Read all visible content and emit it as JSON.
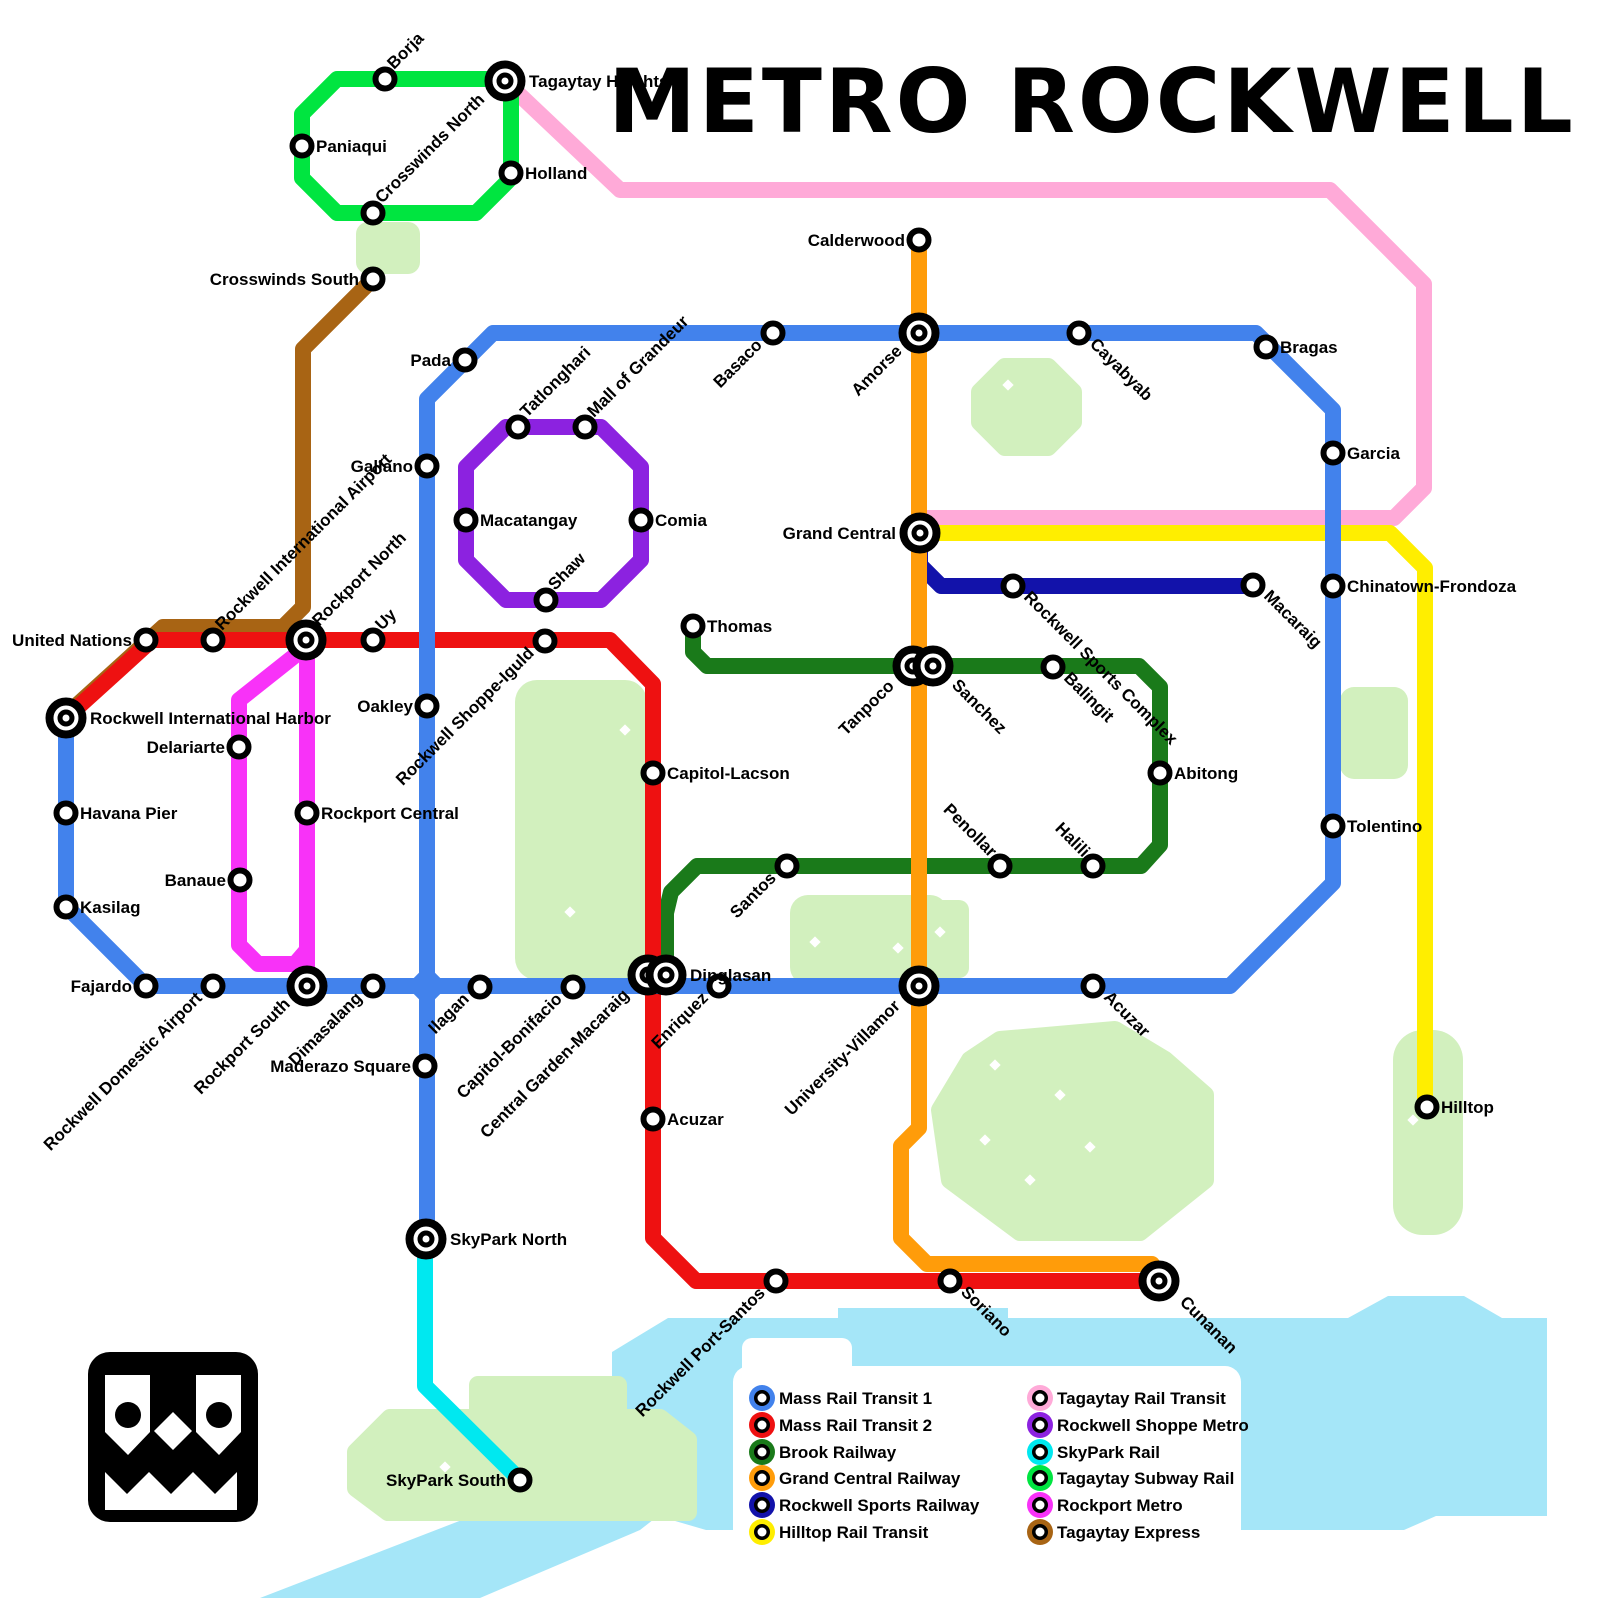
{
  "title": "METRO ROCKWELL",
  "colors": {
    "background": "#ffffff",
    "park": "#d2f0be",
    "water": "#a5e6f8",
    "label": "#000000"
  },
  "legend": {
    "columns": [
      [
        {
          "label": "Mass Rail Transit 1",
          "color": "#4282ec"
        },
        {
          "label": "Mass Rail Transit 2",
          "color": "#ee1111"
        },
        {
          "label": "Brook Railway",
          "color": "#1a7a1a"
        },
        {
          "label": "Grand Central Railway",
          "color": "#ff9c0a"
        },
        {
          "label": "Rockwell Sports Railway",
          "color": "#1212aa"
        },
        {
          "label": "Hilltop Rail Transit",
          "color": "#ffee00"
        }
      ],
      [
        {
          "label": "Tagaytay Rail Transit",
          "color": "#ffaad8"
        },
        {
          "label": "Rockwell Shoppe Metro",
          "color": "#8c22e0"
        },
        {
          "label": "SkyPark Rail",
          "color": "#00e8f0"
        },
        {
          "label": "Tagaytay Subway Rail",
          "color": "#00e540"
        },
        {
          "label": "Rockport Metro",
          "color": "#f832f8"
        },
        {
          "label": "Tagaytay Express",
          "color": "#a86414"
        }
      ]
    ]
  },
  "lines": [
    {
      "id": "tagaytay-rail-transit",
      "name": "Tagaytay Rail Transit",
      "color": "#ffaad8",
      "paths": [
        [
          [
            505,
            81
          ],
          [
            620,
            190
          ],
          [
            1330,
            190
          ],
          [
            1424,
            284
          ],
          [
            1424,
            488
          ],
          [
            1394,
            518
          ],
          [
            920,
            518
          ]
        ]
      ]
    },
    {
      "id": "hilltop-rail-transit",
      "name": "Hilltop Rail Transit",
      "color": "#ffee00",
      "paths": [
        [
          [
            920,
            533
          ],
          [
            1390,
            533
          ],
          [
            1425,
            568
          ],
          [
            1425,
            1107
          ]
        ]
      ]
    },
    {
      "id": "rockwell-sports-railway",
      "name": "Rockwell Sports Railway",
      "color": "#1212aa",
      "paths": [
        [
          [
            920,
            540
          ],
          [
            920,
            565
          ],
          [
            941,
            586
          ],
          [
            1253,
            586
          ]
        ]
      ]
    },
    {
      "id": "tagaytay-express",
      "name": "Tagaytay Express",
      "color": "#a86414",
      "paths": [
        [
          [
            373,
            279
          ],
          [
            303,
            349
          ],
          [
            303,
            607
          ],
          [
            283,
            627
          ],
          [
            163,
            627
          ],
          [
            66,
            715
          ]
        ]
      ]
    },
    {
      "id": "rockport-metro",
      "name": "Rockport Metro",
      "color": "#f832f8",
      "paths": [
        [
          [
            307,
            650
          ],
          [
            307,
            978
          ]
        ],
        [
          [
            302,
            650
          ],
          [
            239,
            700
          ],
          [
            239,
            945
          ],
          [
            258,
            964
          ],
          [
            295,
            964
          ],
          [
            307,
            950
          ]
        ]
      ]
    },
    {
      "id": "skypark-rail",
      "name": "SkyPark Rail",
      "color": "#00e8f0",
      "paths": [
        [
          [
            425,
            1250
          ],
          [
            425,
            1386
          ],
          [
            518,
            1478
          ]
        ]
      ]
    },
    {
      "id": "tagaytay-subway-rail",
      "name": "Tagaytay Subway Rail",
      "color": "#00e540",
      "paths": [
        [
          [
            337,
            79
          ],
          [
            497,
            79
          ],
          [
            511,
            93
          ],
          [
            511,
            178
          ],
          [
            476,
            213
          ],
          [
            337,
            213
          ],
          [
            302,
            178
          ],
          [
            302,
            114
          ],
          [
            337,
            79
          ]
        ]
      ]
    },
    {
      "id": "rockwell-shoppe-metro",
      "name": "Rockwell Shoppe Metro",
      "color": "#8c22e0",
      "paths": [
        [
          [
            506,
            427
          ],
          [
            601,
            427
          ],
          [
            641,
            467
          ],
          [
            641,
            560
          ],
          [
            601,
            600
          ],
          [
            506,
            600
          ],
          [
            466,
            560
          ],
          [
            466,
            467
          ],
          [
            506,
            427
          ]
        ]
      ]
    },
    {
      "id": "brook-railway",
      "name": "Brook Railway",
      "color": "#1a7a1a",
      "paths": [
        [
          [
            693,
            626
          ],
          [
            693,
            652
          ],
          [
            707,
            666
          ],
          [
            1139,
            666
          ],
          [
            1160,
            687
          ],
          [
            1160,
            845
          ],
          [
            1141,
            866
          ],
          [
            697,
            866
          ],
          [
            671,
            892
          ],
          [
            666,
            913
          ],
          [
            666,
            970
          ]
        ]
      ]
    },
    {
      "id": "mass-rail-transit-2",
      "name": "Mass Rail Transit 2",
      "color": "#ee1111",
      "paths": [
        [
          [
            66,
            718
          ],
          [
            152,
            640
          ],
          [
            610,
            640
          ],
          [
            653,
            684
          ],
          [
            653,
            1238
          ],
          [
            696,
            1281
          ],
          [
            1159,
            1281
          ]
        ]
      ]
    },
    {
      "id": "grand-central-railway",
      "name": "Grand Central Railway",
      "color": "#ff9c0a",
      "paths": [
        [
          [
            919,
            240
          ],
          [
            919,
            1128
          ],
          [
            901,
            1146
          ],
          [
            901,
            1238
          ],
          [
            927,
            1264
          ],
          [
            1152,
            1264
          ]
        ]
      ]
    },
    {
      "id": "mass-rail-transit-1",
      "name": "Mass Rail Transit 1",
      "color": "#4282ec",
      "paths": [
        [
          [
            66,
            718
          ],
          [
            66,
            906
          ],
          [
            146,
            986
          ],
          [
            1230,
            986
          ],
          [
            1333,
            883
          ],
          [
            1333,
            410
          ],
          [
            1256,
            333
          ],
          [
            493,
            333
          ],
          [
            427,
            399
          ],
          [
            427,
            1239
          ]
        ]
      ]
    }
  ],
  "stations": [
    {
      "n": "Borja",
      "x": 385,
      "y": 79,
      "t": "s",
      "r": -45,
      "a": "s"
    },
    {
      "n": "Tagaytay Heights",
      "x": 505,
      "y": 81,
      "t": "i",
      "r": 0,
      "a": "s",
      "dx": 10
    },
    {
      "n": "Paniaqui",
      "x": 302,
      "y": 146,
      "t": "s",
      "r": 0,
      "a": "s"
    },
    {
      "n": "Holland",
      "x": 511,
      "y": 173,
      "t": "s",
      "r": 0,
      "a": "s"
    },
    {
      "n": "Crosswinds North",
      "x": 373,
      "y": 213,
      "t": "s",
      "r": -45,
      "a": "s"
    },
    {
      "n": "Crosswinds South",
      "x": 373,
      "y": 279,
      "t": "s",
      "r": 0,
      "a": "e"
    },
    {
      "n": "United Nations",
      "x": 146,
      "y": 640,
      "t": "s",
      "r": 0,
      "a": "e"
    },
    {
      "n": "Rockwell International Airport",
      "x": 213,
      "y": 640,
      "t": "s",
      "r": -45,
      "a": "s"
    },
    {
      "n": "Rockport North",
      "x": 306,
      "y": 640,
      "t": "i",
      "r": -45,
      "a": "s",
      "dx": 4,
      "dy": -4
    },
    {
      "n": "Uy",
      "x": 373,
      "y": 640,
      "t": "s",
      "r": -45,
      "a": "s"
    },
    {
      "n": "Rockwell Shoppe-Iguld",
      "x": 545,
      "y": 641,
      "t": "s",
      "r": -45,
      "a": "e"
    },
    {
      "n": "Rockwell International Harbor",
      "x": 66,
      "y": 718,
      "t": "i",
      "r": 0,
      "a": "s",
      "dx": 10
    },
    {
      "n": "Havana Pier",
      "x": 66,
      "y": 813,
      "t": "s",
      "r": 0,
      "a": "s"
    },
    {
      "n": "Kasilag",
      "x": 66,
      "y": 907,
      "t": "s",
      "r": 0,
      "a": "s"
    },
    {
      "n": "Fajardo",
      "x": 146,
      "y": 986,
      "t": "s",
      "r": 0,
      "a": "e"
    },
    {
      "n": "Rockwell Domestic Airport",
      "x": 213,
      "y": 986,
      "t": "s",
      "r": -45,
      "a": "e"
    },
    {
      "n": "Rockport South",
      "x": 307,
      "y": 986,
      "t": "i",
      "r": -45,
      "a": "e",
      "dx": -6,
      "dy": 6
    },
    {
      "n": "Dimasalang",
      "x": 373,
      "y": 986,
      "t": "s",
      "r": -45,
      "a": "e"
    },
    {
      "n": "Ilagan",
      "x": 480,
      "y": 987,
      "t": "s",
      "r": -45,
      "a": "e"
    },
    {
      "n": "Capitol-Bonifacio",
      "x": 573,
      "y": 987,
      "t": "s",
      "r": -45,
      "a": "e"
    },
    {
      "n": "Central Garden-Macaraig",
      "x": 648,
      "y": 975,
      "t": "i",
      "r": -45,
      "a": "e",
      "dx": -8,
      "dy": 8
    },
    {
      "n": "Dinglasan",
      "x": 666,
      "y": 975,
      "t": "i",
      "r": 0,
      "a": "s",
      "dx": 10
    },
    {
      "n": "Enriquez",
      "x": 719,
      "y": 986,
      "t": "s",
      "r": -45,
      "a": "e"
    },
    {
      "n": "Maderazo Square",
      "x": 425,
      "y": 1066,
      "t": "s",
      "r": 0,
      "a": "e"
    },
    {
      "n": "Banaue",
      "x": 240,
      "y": 880,
      "t": "s",
      "r": 0,
      "a": "e"
    },
    {
      "n": "Delariarte",
      "x": 239,
      "y": 747,
      "t": "s",
      "r": 0,
      "a": "e"
    },
    {
      "n": "Rockport Central",
      "x": 307,
      "y": 813,
      "t": "s",
      "r": 0,
      "a": "s"
    },
    {
      "n": "Oakley",
      "x": 427,
      "y": 706,
      "t": "s",
      "r": 0,
      "a": "e"
    },
    {
      "n": "Galiano",
      "x": 427,
      "y": 466,
      "t": "s",
      "r": 0,
      "a": "e"
    },
    {
      "n": "Pada",
      "x": 465,
      "y": 360,
      "t": "s",
      "r": 0,
      "a": "e"
    },
    {
      "n": "Tatlonghari",
      "x": 518,
      "y": 427,
      "t": "s",
      "r": -45,
      "a": "s"
    },
    {
      "n": "Mall of Grandeur",
      "x": 585,
      "y": 427,
      "t": "s",
      "r": -45,
      "a": "s"
    },
    {
      "n": "Macatangay",
      "x": 466,
      "y": 520,
      "t": "s",
      "r": 0,
      "a": "s"
    },
    {
      "n": "Comia",
      "x": 641,
      "y": 520,
      "t": "s",
      "r": 0,
      "a": "s"
    },
    {
      "n": "Shaw",
      "x": 546,
      "y": 600,
      "t": "s",
      "r": -45,
      "a": "s"
    },
    {
      "n": "Basaco",
      "x": 773,
      "y": 333,
      "t": "s",
      "r": -45,
      "a": "e"
    },
    {
      "n": "Amorse",
      "x": 919,
      "y": 333,
      "t": "i",
      "r": -45,
      "a": "e",
      "dx": -6,
      "dy": 6
    },
    {
      "n": "Cayabyab",
      "x": 1079,
      "y": 333,
      "t": "s",
      "r": 45,
      "a": "s"
    },
    {
      "n": "Bragas",
      "x": 1266,
      "y": 347,
      "t": "s",
      "r": 0,
      "a": "s"
    },
    {
      "n": "Garcia",
      "x": 1333,
      "y": 453,
      "t": "s",
      "r": 0,
      "a": "s"
    },
    {
      "n": "Chinatown-Frondoza",
      "x": 1333,
      "y": 586,
      "t": "s",
      "r": 0,
      "a": "s"
    },
    {
      "n": "Tolentino",
      "x": 1333,
      "y": 826,
      "t": "s",
      "r": 0,
      "a": "s"
    },
    {
      "n": "Calderwood",
      "x": 919,
      "y": 240,
      "t": "s",
      "r": 0,
      "a": "e"
    },
    {
      "n": "Grand Central",
      "x": 920,
      "y": 533,
      "t": "i",
      "r": 0,
      "a": "e",
      "dx": -10
    },
    {
      "n": "Thomas",
      "x": 693,
      "y": 626,
      "t": "s",
      "r": 0,
      "a": "s"
    },
    {
      "n": "Tanpoco",
      "x": 913,
      "y": 666,
      "t": "i",
      "r": -45,
      "a": "e",
      "dx": -8,
      "dy": 8
    },
    {
      "n": "Sanchez",
      "x": 933,
      "y": 666,
      "t": "i",
      "r": 45,
      "a": "s",
      "dx": 8,
      "dy": 8
    },
    {
      "n": "Rockwell Sports Complex",
      "x": 1013,
      "y": 586,
      "t": "s",
      "r": 45,
      "a": "s"
    },
    {
      "n": "Balingit",
      "x": 1053,
      "y": 667,
      "t": "s",
      "r": 45,
      "a": "s"
    },
    {
      "n": "Macaraig",
      "x": 1253,
      "y": 585,
      "t": "s",
      "r": 45,
      "a": "s"
    },
    {
      "n": "Abitong",
      "x": 1160,
      "y": 773,
      "t": "s",
      "r": 0,
      "a": "s"
    },
    {
      "n": "Halili",
      "x": 1093,
      "y": 866,
      "t": "s",
      "r": 45,
      "a": "e"
    },
    {
      "n": "Penollar",
      "x": 1000,
      "y": 866,
      "t": "s",
      "r": 45,
      "a": "e"
    },
    {
      "n": "Santos",
      "x": 787,
      "y": 866,
      "t": "s",
      "r": -45,
      "a": "e"
    },
    {
      "n": "Capitol-Lacson",
      "x": 653,
      "y": 773,
      "t": "s",
      "r": 0,
      "a": "s"
    },
    {
      "n": "Acuzar",
      "x": 653,
      "y": 1119,
      "t": "s",
      "r": 0,
      "a": "s"
    },
    {
      "n": "University-Villamor",
      "x": 919,
      "y": 986,
      "t": "i",
      "r": -45,
      "a": "e",
      "dx": -8,
      "dy": 8
    },
    {
      "n": "Acuzar",
      "x": 1093,
      "y": 986,
      "t": "s",
      "r": 45,
      "a": "s"
    },
    {
      "n": "SkyPark North",
      "x": 426,
      "y": 1239,
      "t": "i",
      "r": 0,
      "a": "s",
      "dx": 10
    },
    {
      "n": "SkyPark South",
      "x": 520,
      "y": 1480,
      "t": "s",
      "r": 0,
      "a": "e"
    },
    {
      "n": "Rockwell Port-Santos",
      "x": 776,
      "y": 1281,
      "t": "s",
      "r": -45,
      "a": "e"
    },
    {
      "n": "Soriano",
      "x": 950,
      "y": 1281,
      "t": "s",
      "r": 45,
      "a": "s"
    },
    {
      "n": "Cunanan",
      "x": 1159,
      "y": 1281,
      "t": "i",
      "r": 45,
      "a": "s",
      "dx": 10,
      "dy": 10
    },
    {
      "n": "Hilltop",
      "x": 1427,
      "y": 1107,
      "t": "s",
      "r": 0,
      "a": "s"
    }
  ],
  "parks": [
    {
      "type": "rect",
      "x": 356,
      "y": 222,
      "w": 64,
      "h": 52,
      "rad": 12
    },
    {
      "type": "poly",
      "points": "1005,367 1048,367 1073,392 1073,422 1048,447 1005,447 980,422 980,392"
    },
    {
      "type": "rect",
      "x": 515,
      "y": 680,
      "w": 132,
      "h": 300,
      "rad": 22
    },
    {
      "type": "rect",
      "x": 1340,
      "y": 687,
      "w": 68,
      "h": 92,
      "rad": 14
    },
    {
      "type": "rect",
      "x": 927,
      "y": 900,
      "w": 42,
      "h": 78,
      "rad": 10
    },
    {
      "type": "rect",
      "x": 790,
      "y": 895,
      "w": 158,
      "h": 90,
      "rad": 18
    },
    {
      "type": "poly",
      "points": "1000,1040 1115,1030 1165,1060 1205,1095 1205,1180 1140,1232 1020,1232 950,1180 940,1110 970,1060"
    },
    {
      "type": "rect",
      "x": 1393,
      "y": 1030,
      "w": 70,
      "h": 205,
      "rad": 30
    },
    {
      "type": "poly",
      "points": "478,1385 618,1385 618,1418 660,1418 688,1440 688,1512 388,1512 356,1488 356,1452 390,1418 478,1418"
    }
  ],
  "water": {
    "points": "668,1318 838,1318 838,1308 1008,1308 1008,1318 1348,1318 1388,1296 1464,1296 1502,1318 1547,1318 1547,1516 1436,1516 1404,1530 706,1530 658,1516 640,1530 480,1598 260,1598 612,1462 612,1352"
  },
  "sparkles": [
    [
      625,
      730
    ],
    [
      570,
      912
    ],
    [
      815,
      942
    ],
    [
      898,
      948
    ],
    [
      940,
      932
    ],
    [
      995,
      1065
    ],
    [
      1060,
      1095
    ],
    [
      1090,
      1147
    ],
    [
      985,
      1140
    ],
    [
      1030,
      1180
    ],
    [
      1413,
      1120
    ],
    [
      445,
      1467
    ],
    [
      1008,
      385
    ]
  ],
  "junction": {
    "x": 427,
    "y": 986
  },
  "legend_layout": {
    "panel": {
      "x": 733,
      "y": 1366,
      "w": 508,
      "h": 182,
      "rad": 16
    },
    "tab": {
      "x": 742,
      "y": 1338,
      "w": 110,
      "h": 40,
      "rad": 10
    },
    "col_x": [
      762,
      1040
    ],
    "row_y": [
      1398,
      1425,
      1452,
      1478,
      1505,
      1532
    ]
  },
  "logo_name": "metro-rockwell-logo"
}
